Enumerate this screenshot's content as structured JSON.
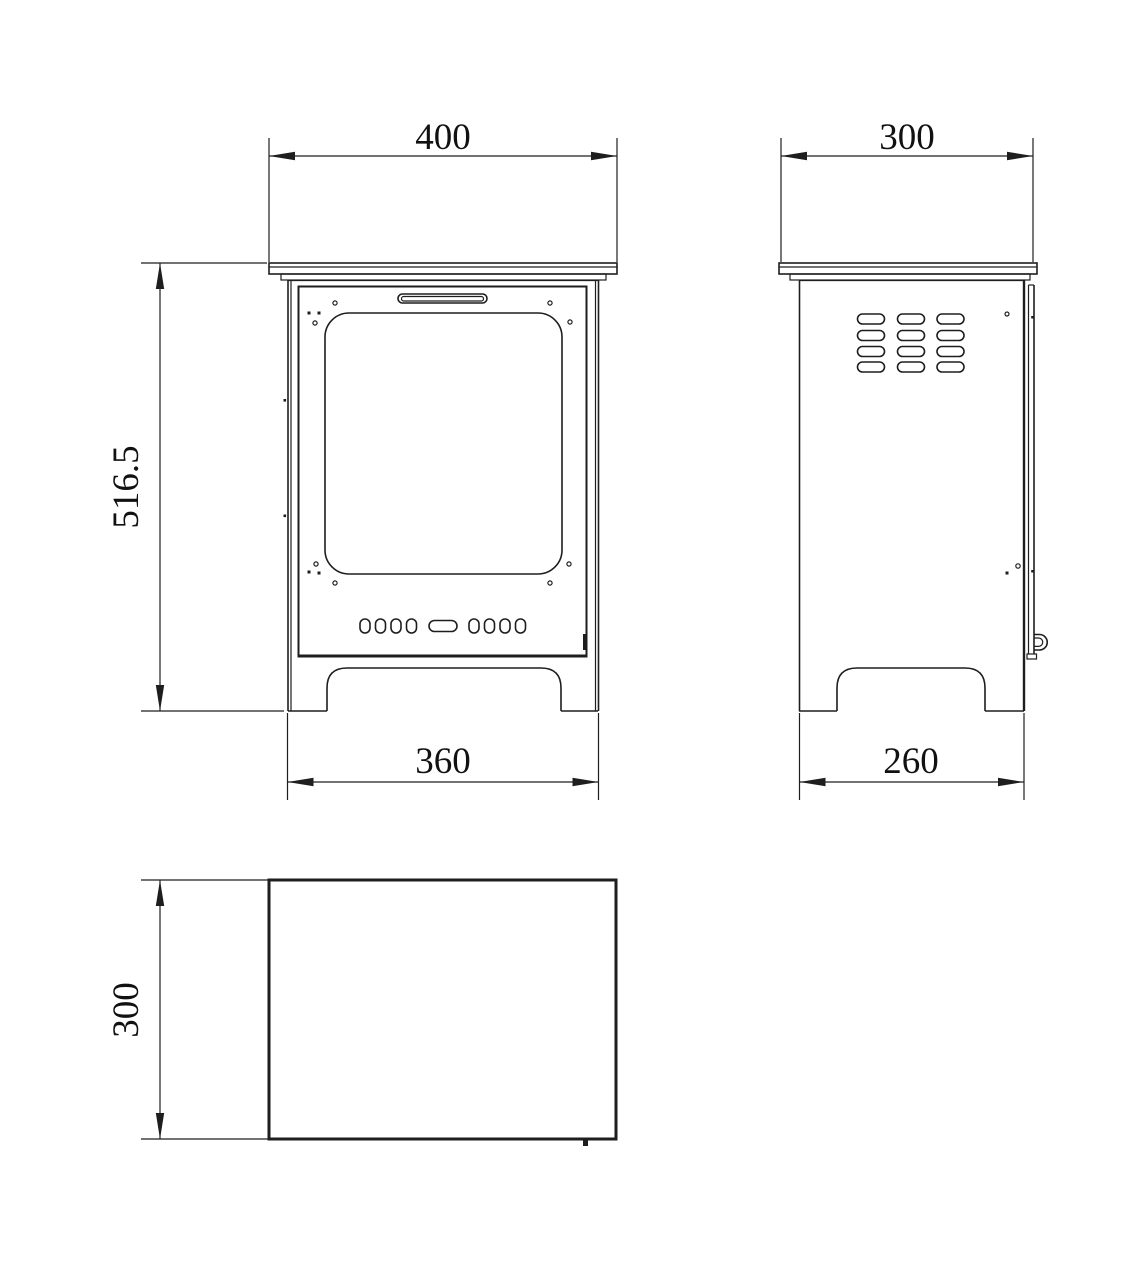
{
  "drawing": {
    "background_color": "#ffffff",
    "line_color": "#1e1e1e",
    "text_color": "#111111",
    "dimensions": {
      "front_width_top": "400",
      "side_depth_top": "300",
      "front_height": "516.5",
      "front_width_base": "360",
      "side_depth_base": "260",
      "plan_depth": "300"
    }
  }
}
